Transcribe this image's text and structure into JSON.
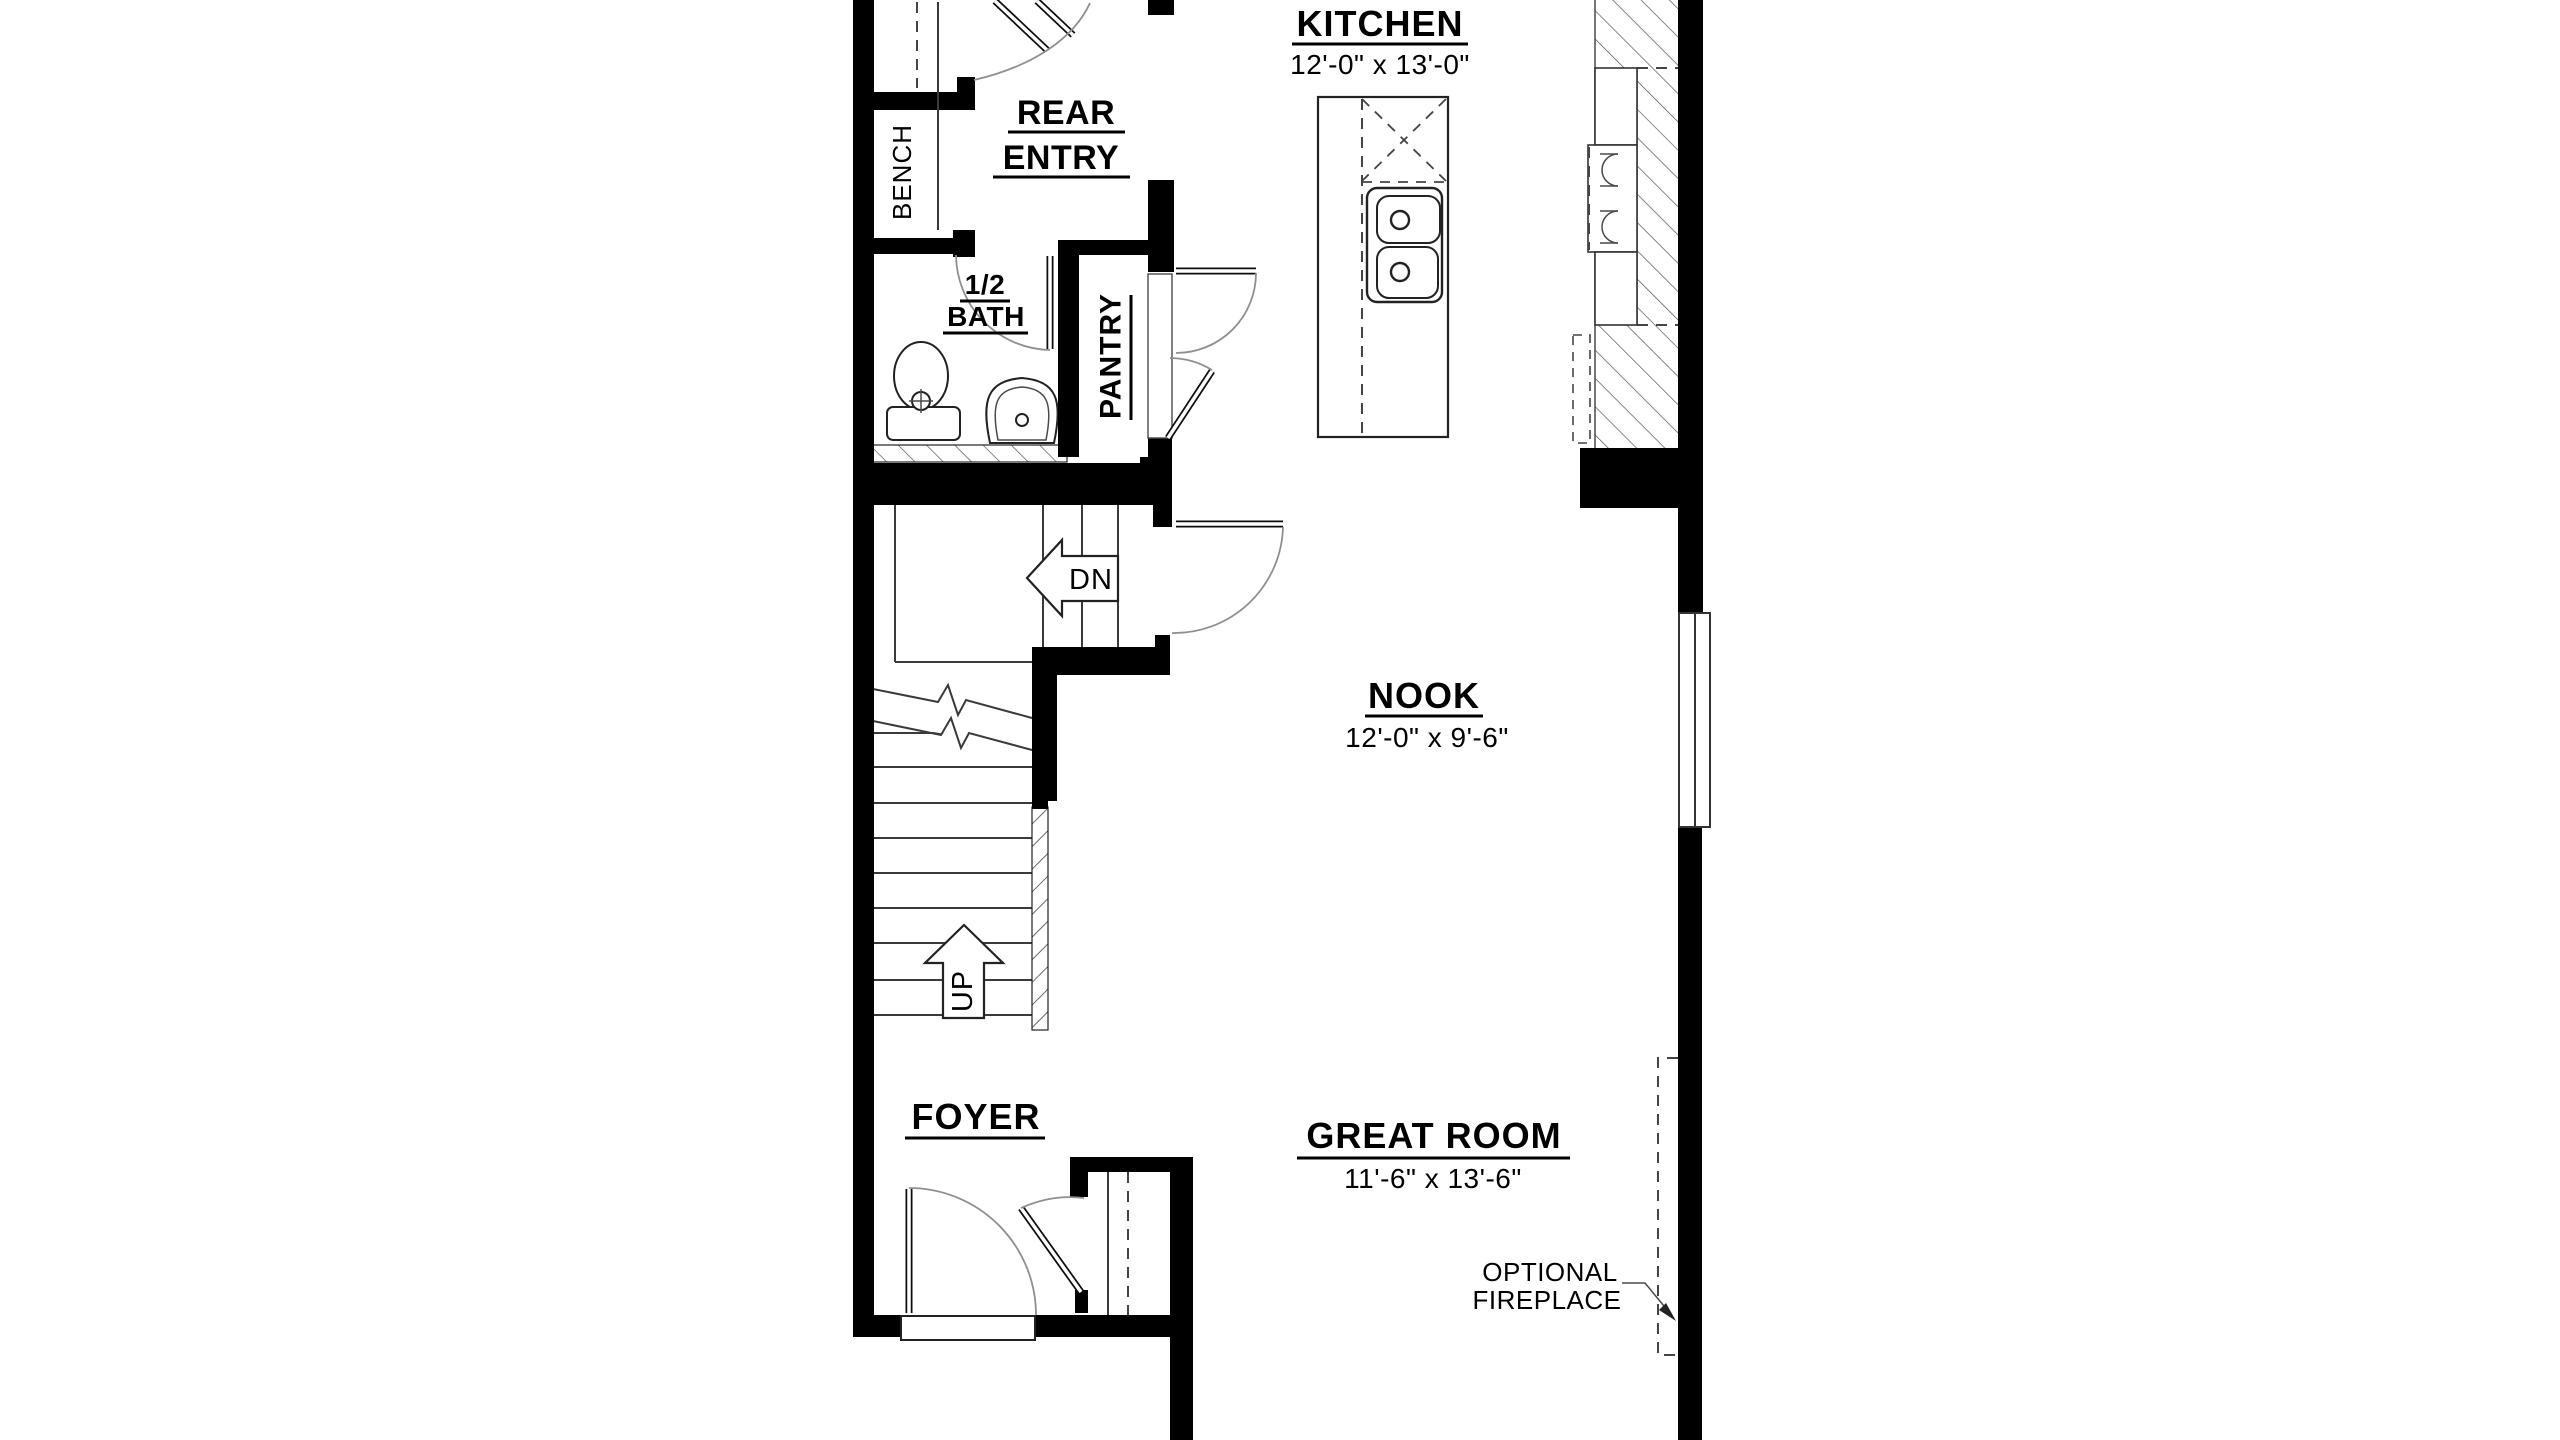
{
  "plan": {
    "title": "first-floor-plan",
    "rooms": {
      "kitchen": {
        "name": "KITCHEN",
        "dims": "12'-0\" x 13'-0\""
      },
      "rear_entry": {
        "line1": "REAR",
        "line2": "ENTRY"
      },
      "bench": {
        "name": "BENCH"
      },
      "half_bath": {
        "line1": "1/2",
        "line2": "BATH"
      },
      "pantry": {
        "name": "PANTRY"
      },
      "nook": {
        "name": "NOOK",
        "dims": "12'-0\" x 9'-6\""
      },
      "foyer": {
        "name": "FOYER"
      },
      "great_room": {
        "name": "GREAT ROOM",
        "dims": "11'-6\" x 13'-6\""
      }
    },
    "stairs": {
      "down_label": "DN",
      "up_label": "UP"
    },
    "annotations": {
      "fireplace_line1": "OPTIONAL",
      "fireplace_line2": "FIREPLACE"
    },
    "colors": {
      "background": "#ffffff",
      "wall": "#000000",
      "line": "#3a3a3a",
      "door_arc": "#8f8f8f"
    }
  }
}
